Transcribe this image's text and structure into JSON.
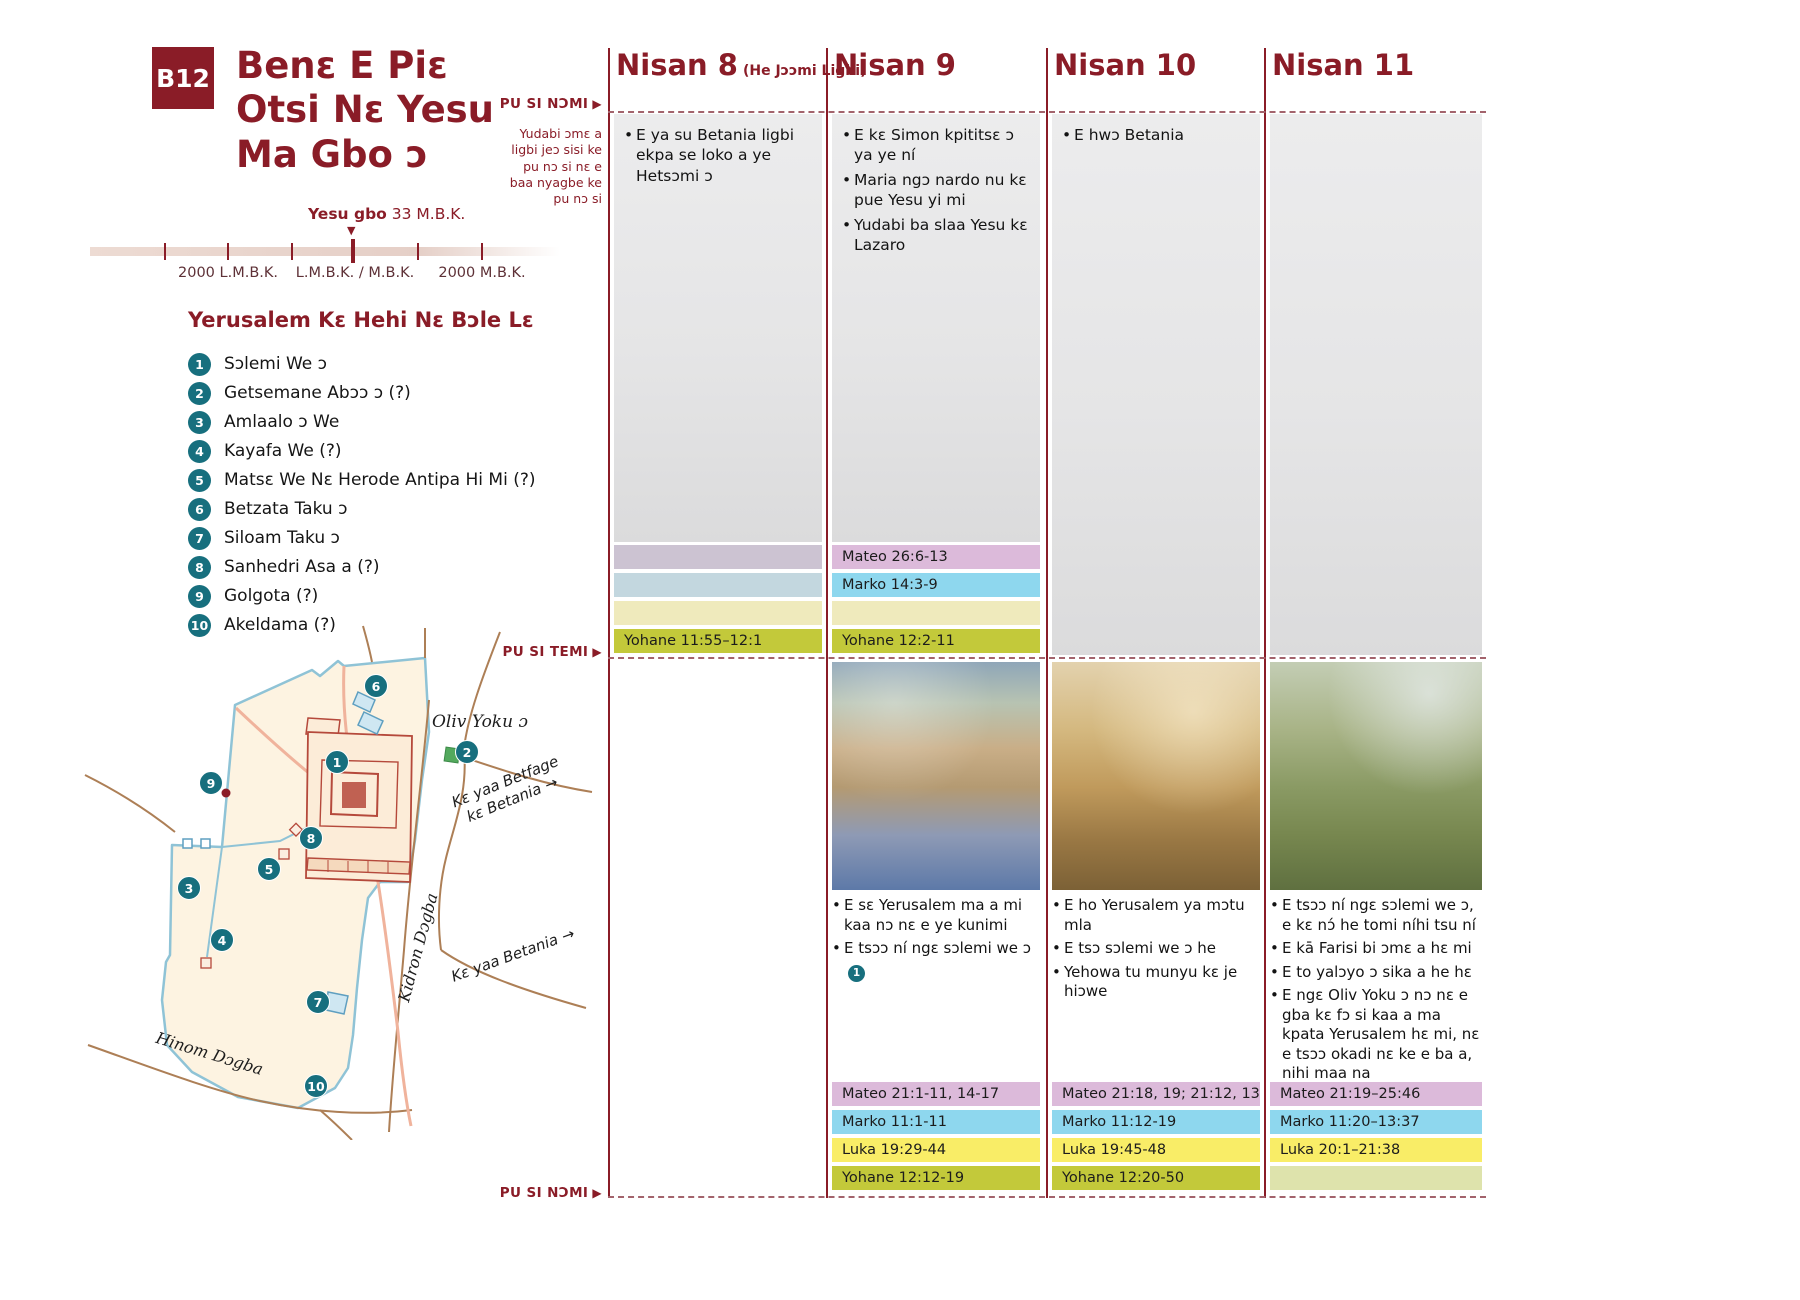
{
  "icons": {
    "right_triangle": "▶",
    "down_triangle": "▼",
    "right_arrow": "→"
  },
  "colors": {
    "maroon": "#8a1c27",
    "teal_marker": "#176f7e",
    "band_mateo": "#dcbada",
    "band_marko": "#8ed7ee",
    "band_luka": "#f9ed67",
    "band_yohane": "#c3c93a"
  },
  "header": {
    "badge": "B12",
    "title": "Benɛ E Piɛ\nOtsi Nɛ Yesu\nMa Gbo ɔ"
  },
  "timeline": {
    "event_bold": "Yesu gbo",
    "event_rest": " 33 M.B.K.",
    "tick_labels": [
      "2000 L.M.B.K.",
      "L.M.B.K. / M.B.K.",
      "2000 M.B.K."
    ]
  },
  "legend": {
    "title": "Yerusalem Kɛ Hehi Nɛ Bɔle Lɛ",
    "items": [
      {
        "num": "1",
        "label": "Sɔlemi We ɔ"
      },
      {
        "num": "2",
        "label": "Getsemane Abɔɔ ɔ (?)"
      },
      {
        "num": "3",
        "label": "Amlaalo ɔ We"
      },
      {
        "num": "4",
        "label": "Kayafa We (?)"
      },
      {
        "num": "5",
        "label": "Matsɛ We Nɛ Herode Antipa Hi Mi (?)"
      },
      {
        "num": "6",
        "label": "Betzata Taku ɔ"
      },
      {
        "num": "7",
        "label": "Siloam Taku ɔ"
      },
      {
        "num": "8",
        "label": "Sanhedri Asa a (?)"
      },
      {
        "num": "9",
        "label": "Golgota (?)"
      },
      {
        "num": "10",
        "label": "Akeldama (?)"
      }
    ]
  },
  "margin": {
    "top_label": "PU SI NƆMI",
    "note": "Yudabi ɔmɛ a\nligbi jeɔ sisi ke\npu nɔ si nɛ e\nbaa nyagbe ke\npu nɔ si",
    "mid_label": "PU SI TEMI",
    "bottom_label": "PU SI NƆMI"
  },
  "map": {
    "labels": {
      "mount": "Oliv Yoku ɔ",
      "road_betfage": "Kɛ yaa Betfage\nkɛ Betania",
      "road_betania": "Kɛ yaa Betania",
      "kidron": "Kidron Dɔgba",
      "hinom": "Hinom Dɔgba"
    },
    "markers": [
      "1",
      "2",
      "3",
      "4",
      "5",
      "6",
      "7",
      "8",
      "9",
      "10"
    ]
  },
  "columns": [
    {
      "header": "Nisan 8",
      "header_sub": "(He Jɔɔmi Ligbi)",
      "top_events": [
        "E ya su Betania ligbi ekpa se loko a ye Hetsɔmi ɔ"
      ],
      "mid_bands": [
        {
          "text": ""
        },
        {
          "text": ""
        },
        {
          "text": ""
        },
        {
          "text": "Yohane 11:55–12:1"
        }
      ]
    },
    {
      "header": "Nisan 9",
      "top_events": [
        "E kɛ Simon kpititsɛ ɔ ya ye ní",
        "Maria ngɔ nardo nu kɛ pue Yesu yi mi",
        "Yudabi ba slaa Yesu kɛ Lazaro"
      ],
      "mid_bands": [
        {
          "text": "Mateo 26:6-13"
        },
        {
          "text": "Marko 14:3-9"
        },
        {
          "text": ""
        },
        {
          "text": "Yohane 12:2-11"
        }
      ],
      "bottom_events": [
        "E sɛ Yerusalem ma a mi kaa nɔ nɛ e ye kunimi",
        "E tsɔɔ ní ngɛ sɔlemi we ɔ"
      ],
      "bottom_inline_marker": "1",
      "bottom_bands": [
        {
          "text": "Mateo 21:1-11, 14-17"
        },
        {
          "text": "Marko 11:1-11"
        },
        {
          "text": "Luka 19:29-44"
        },
        {
          "text": "Yohane 12:12-19"
        }
      ]
    },
    {
      "header": "Nisan 10",
      "top_events": [
        "E hwɔ Betania"
      ],
      "bottom_events": [
        "E ho Yerusalem ya mɔtu mla",
        "E tsɔ sɔlemi we ɔ he",
        "Yehowa tu munyu kɛ je hiɔwe"
      ],
      "bottom_bands": [
        {
          "text": "Mateo 21:18, 19; 21:12, 13"
        },
        {
          "text": "Marko 11:12-19"
        },
        {
          "text": "Luka 19:45-48"
        },
        {
          "text": "Yohane 12:20-50"
        }
      ]
    },
    {
      "header": "Nisan 11",
      "bottom_events": [
        "E tsɔɔ ní ngɛ sɔlemi we ɔ, e kɛ nɔ́ he tomi níhi tsu ní",
        "E kā Farisi bi ɔmɛ a hɛ mi",
        "E to yalɔyo ɔ sika a he hɛ",
        "E ngɛ Oliv Yoku ɔ nɔ nɛ e gba kɛ fɔ si kaa a ma kpata Yerusalem hɛ mi, nɛ e tsɔɔ okadi nɛ ke e ba a, nihi maa na"
      ],
      "bottom_bands": [
        {
          "text": "Mateo 21:19–25:46"
        },
        {
          "text": "Marko 11:20–13:37"
        },
        {
          "text": "Luka 20:1–21:38"
        },
        {
          "text": ""
        }
      ]
    }
  ]
}
